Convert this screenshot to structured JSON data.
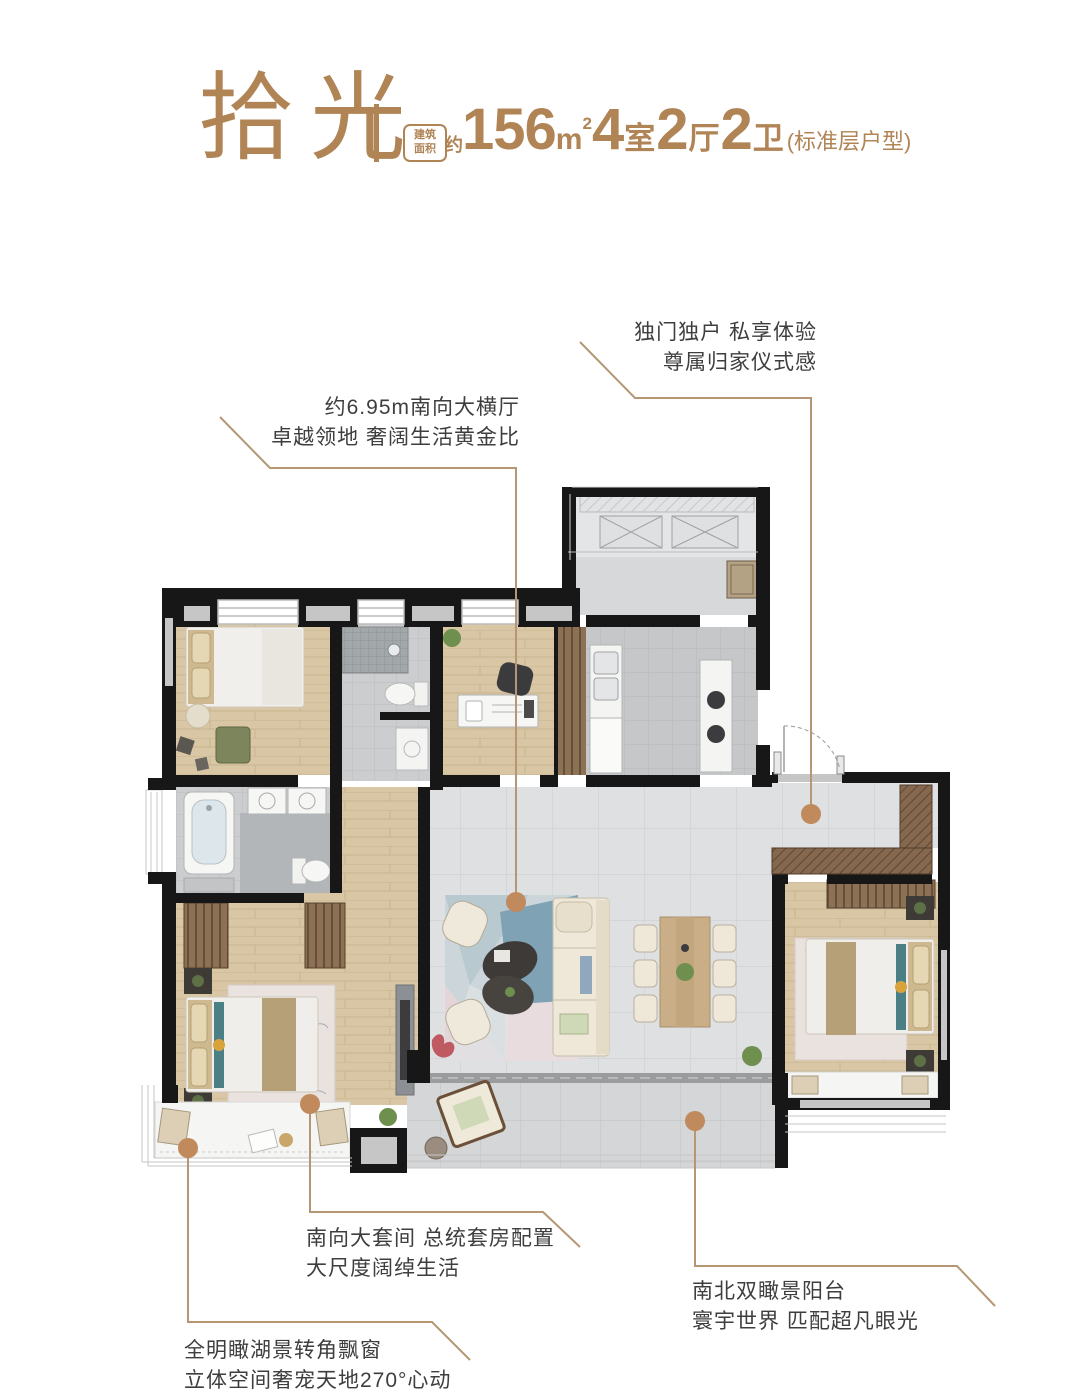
{
  "colors": {
    "accent": "#b08455",
    "line": "#b59775",
    "dot": "#c08a5c",
    "ink": "#3e3e3e"
  },
  "header": {
    "title": "拾光",
    "area_box": {
      "line1": "建筑",
      "line2": "面积"
    },
    "approx": "约",
    "spec": {
      "area_num": "156",
      "area_unit": "m",
      "area_sup": "2",
      "beds_num": "4",
      "beds_label": "室",
      "living_num": "2",
      "living_label": "厅",
      "baths_num": "2",
      "baths_label": "卫",
      "note": "(标准层户型)"
    }
  },
  "callouts": [
    {
      "id": "entry",
      "lines": [
        "独门独户 私享体验",
        "尊属归家仪式感"
      ]
    },
    {
      "id": "living",
      "lines": [
        "约6.95m南向大横厅",
        "卓越领地 奢阔生活黄金比"
      ]
    },
    {
      "id": "master-suite",
      "lines": [
        "南向大套间 总统套房配置",
        "大尺度阔绰生活"
      ]
    },
    {
      "id": "balcony",
      "lines": [
        "南北双瞰景阳台",
        "寰宇世界 匹配超凡眼光"
      ]
    },
    {
      "id": "bay-window",
      "lines": [
        "全明瞰湖景转角飘窗",
        "立体空间奢宠天地270°心动"
      ]
    }
  ]
}
